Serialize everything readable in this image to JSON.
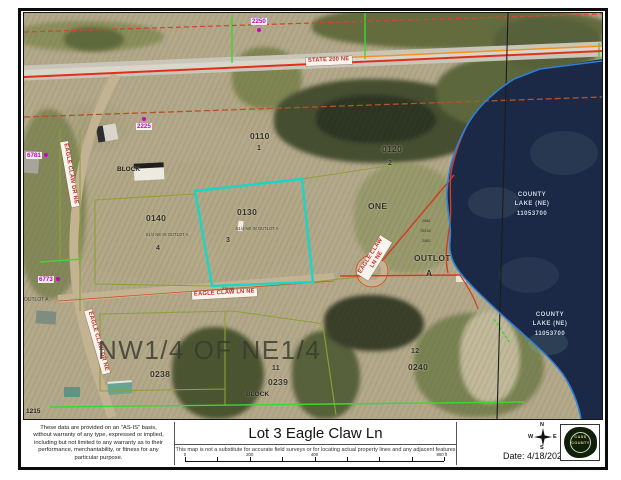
{
  "map": {
    "roads": {
      "state": "STATE 200 NE",
      "dr_upper": "EAGLE CLAW DR NE",
      "dr_lower": "EAGLE CLAW DR NE",
      "ln": "EAGLE CLAW LN NE",
      "ln_rotated_1": "EAGLE CLAW",
      "ln_rotated_2": "LN NE"
    },
    "addresses": {
      "n2250": "2250",
      "n2225": "2225",
      "n6781": "6781",
      "n6773": "6773",
      "n1215": "1215"
    },
    "parcels": {
      "p0110": "0110",
      "p0110_lot": "1",
      "p0120": "0120",
      "p0120_lot": "2",
      "p0130": "0130",
      "p0130_desc": "N1/4 NE IN OUTLOT A",
      "p0130_lot": "3",
      "p0140": "0140",
      "p0140_desc": "S1/4 NE IN OUTLOT A",
      "p0140_lot": "4",
      "p0238": "0238",
      "p0239": "0239",
      "p0239_lot": "11",
      "p0240": "0240",
      "p0240_lot": "12",
      "block_upper": "BLOCK",
      "block_lower": "BLOCK",
      "one": "ONE",
      "outlot": "OUTLOT",
      "outlot_lot": "A",
      "outlot_small": "OUTLOT A"
    },
    "section_overlay": "NW1/4 OF NE1/4",
    "lake": {
      "line1": "COUNTY",
      "line2": "LAKE (NE)",
      "line3": "11053700"
    },
    "survey": {
      "d1": "2082",
      "d2": "70216",
      "d3": "2082",
      "d4": "278.98"
    },
    "colors": {
      "lake": "#1b2946",
      "subject_parcel": "#19d6c6",
      "highway_line": "#e0301c",
      "plat_line": "#3ed636",
      "address": "#cc00cc"
    }
  },
  "footer": {
    "disclaimer": [
      "These data are provided on an \"AS-IS\" basis,",
      "without warranty of any type, expressed or implied,",
      "including but not limited to any warranty as to their",
      "performance, merchantability, or fitness for any",
      "particular purpose."
    ],
    "title": "Lot 3 Eagle Claw Ln",
    "subtitle": "This map is not a substitute for accurate field surveys or for locating actual property lines and any adjacent features",
    "scale": {
      "t0": "0",
      "t1": "200",
      "t2": "400",
      "t3": "800 ft"
    },
    "compass": {
      "n": "N",
      "e": "E",
      "s": "S",
      "w": "W"
    },
    "date": "Date: 4/18/2024",
    "logo": {
      "line1": "CASS",
      "line2": "COUNTY"
    }
  }
}
